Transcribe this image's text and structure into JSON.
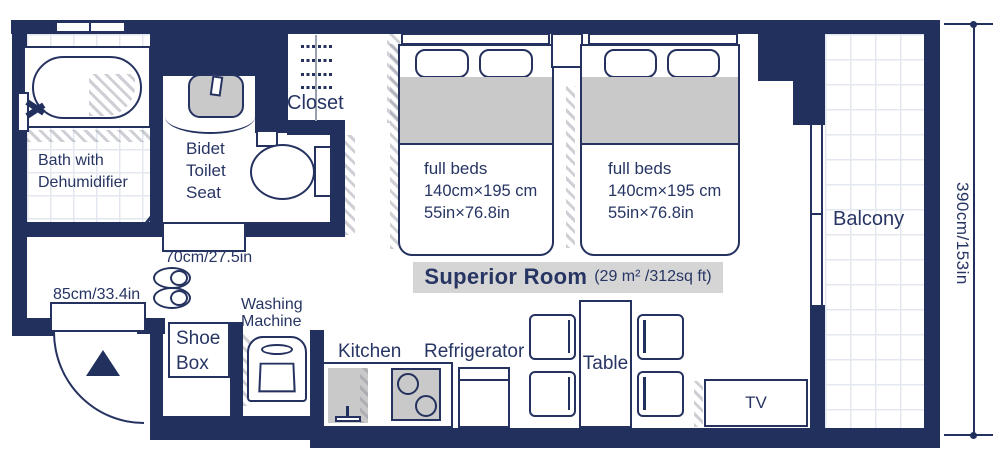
{
  "title": {
    "name": "Superior Room",
    "area": "(29 m² /312sq ft)"
  },
  "rooms": {
    "bath": {
      "line1": "Bath with",
      "line2": "Dehumidifier"
    },
    "toilet": {
      "line1": "Bidet",
      "line2": "Toilet",
      "line3": "Seat"
    },
    "closet": {
      "label": "Closet"
    },
    "balcony": {
      "label": "Balcony"
    }
  },
  "furniture": {
    "shoe_box": {
      "line1": "Shoe",
      "line2": "Box"
    },
    "washing_machine": {
      "line1": "Washing",
      "line2": "Machine"
    },
    "kitchen": {
      "label": "Kitchen"
    },
    "refrigerator": {
      "label": "Refrigerator"
    },
    "table": {
      "label": "Table"
    },
    "tv": {
      "label": "TV"
    }
  },
  "beds": {
    "bed1": {
      "name": "full beds",
      "size_cm": "140cm×195 cm",
      "size_in": "55in×76.8in"
    },
    "bed2": {
      "name": "full beds",
      "size_cm": "140cm×195 cm",
      "size_in": "55in×76.8in"
    }
  },
  "dimensions": {
    "entrance_width": "85cm/33.4in",
    "toilet_door_width": "70cm/27.5in",
    "room_depth": "390cm/153in"
  },
  "colors": {
    "wall": "#22305e",
    "text": "#273563",
    "fill_gray": "#c9c9c9",
    "band_gray": "#d5d5d5"
  }
}
